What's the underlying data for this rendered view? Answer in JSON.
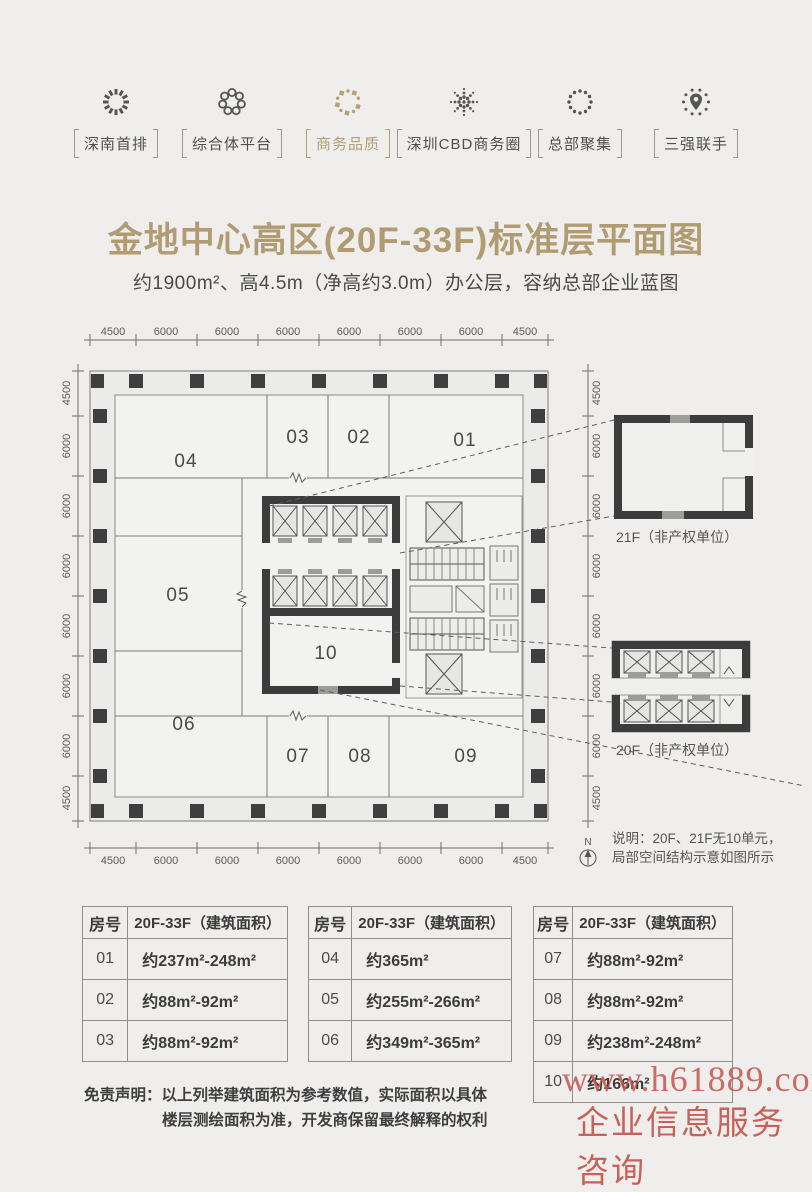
{
  "page": {
    "bg": "#efeeec",
    "accent": "#b3a074"
  },
  "nav": {
    "items": [
      {
        "label": "深南首排",
        "active": false
      },
      {
        "label": "综合体平台",
        "active": false
      },
      {
        "label": "商务品质",
        "active": true
      },
      {
        "label": "深圳CBD商务圈",
        "active": false
      },
      {
        "label": "总部聚集",
        "active": false
      },
      {
        "label": "三强联手",
        "active": false
      }
    ]
  },
  "header": {
    "title": "金地中心高区(20F-33F)标准层平面图",
    "subtitle": "约1900m²、高4.5m（净高约3.0m）办公层，容纳总部企业蓝图"
  },
  "plan": {
    "dims": [
      "4500",
      "6000",
      "6000",
      "6000",
      "6000",
      "6000",
      "6000",
      "4500"
    ],
    "room_labels": [
      "01",
      "02",
      "03",
      "04",
      "05",
      "06",
      "07",
      "08",
      "09",
      "10"
    ],
    "details": [
      {
        "label": "21F（非产权单位）"
      },
      {
        "label": "20F（非产权单位）"
      }
    ],
    "north": "N",
    "note": {
      "line1": "说明：20F、21F无10单元，",
      "line2": "局部空间结构示意如图所示"
    }
  },
  "tables": [
    {
      "headers": [
        "房号",
        "20F-33F（建筑面积）"
      ],
      "rows": [
        [
          "01",
          "约237m²-248m²"
        ],
        [
          "02",
          "约88m²-92m²"
        ],
        [
          "03",
          "约88m²-92m²"
        ]
      ]
    },
    {
      "headers": [
        "房号",
        "20F-33F（建筑面积）"
      ],
      "rows": [
        [
          "04",
          "约365m²"
        ],
        [
          "05",
          "约255m²-266m²"
        ],
        [
          "06",
          "约349m²-365m²"
        ]
      ]
    },
    {
      "headers": [
        "房号",
        "20F-33F（建筑面积）"
      ],
      "rows": [
        [
          "07",
          "约88m²-92m²"
        ],
        [
          "08",
          "约88m²-92m²"
        ],
        [
          "09",
          "约238m²-248m²"
        ],
        [
          "10",
          "约166m²"
        ]
      ]
    }
  ],
  "disclaimer": {
    "label": "免责声明：",
    "line1": "以上列举建筑面积为参考数值，实际面积以具体",
    "line2": "楼层测绘面积为准，开发商保留最终解释的权利"
  },
  "watermark": {
    "line1": "www.h61889.com",
    "line2": "企业信息服务咨询"
  }
}
